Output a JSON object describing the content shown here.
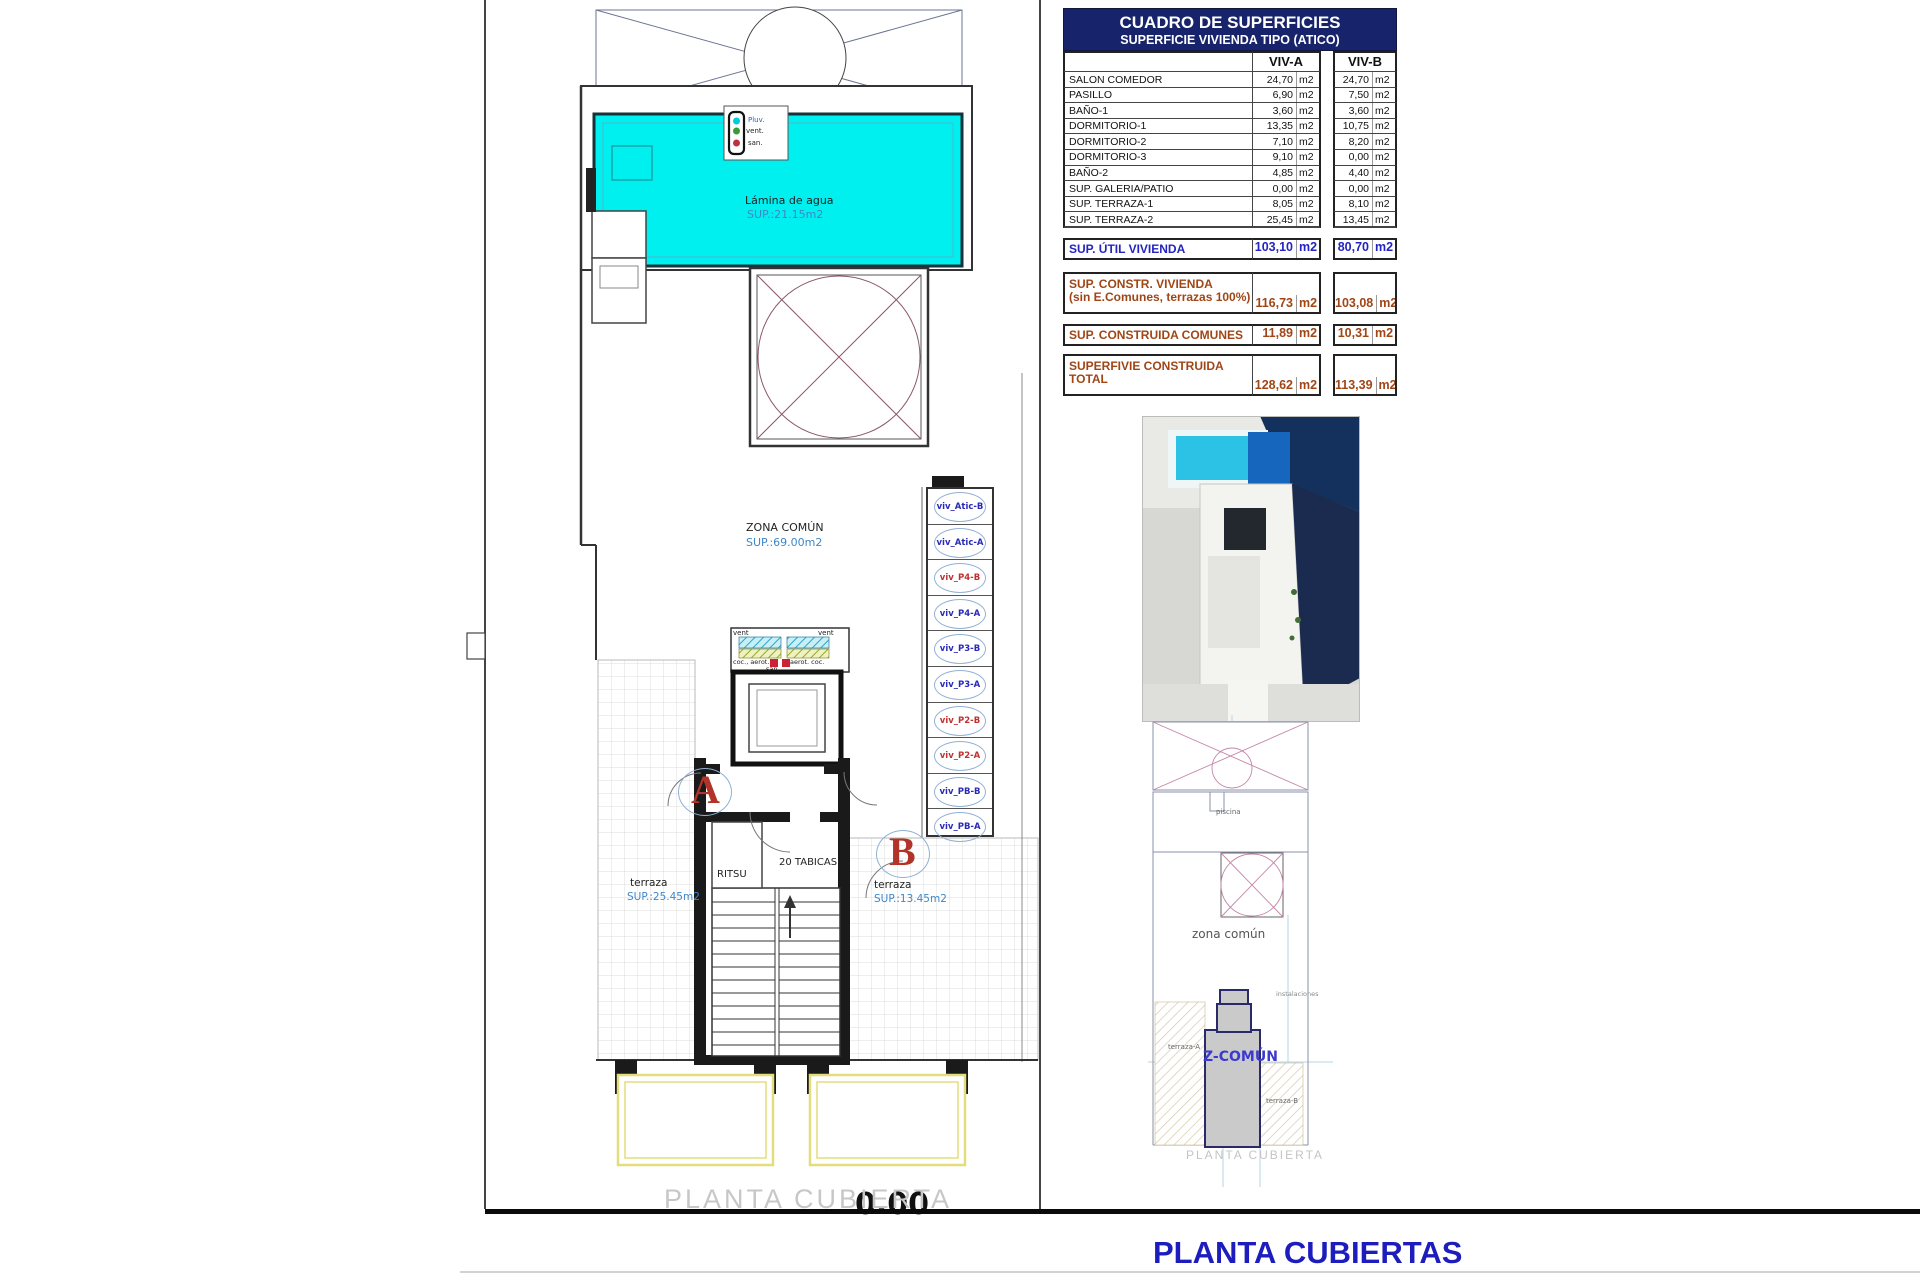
{
  "title": "PLANTA CUBIERTAS",
  "table": {
    "title": "CUADRO DE SUPERFICIES",
    "subtitle": "SUPERFICIE VIVIENDA TIPO  (ATICO)",
    "col_a": "VIV-A",
    "col_b": "VIV-B",
    "unit": "m2",
    "rows": [
      {
        "label": "SALON COMEDOR",
        "a": "24,70",
        "b": "24,70"
      },
      {
        "label": "PASILLO",
        "a": "6,90",
        "b": "7,50"
      },
      {
        "label": "BAÑO-1",
        "a": "3,60",
        "b": "3,60"
      },
      {
        "label": "DORMITORIO-1",
        "a": "13,35",
        "b": "10,75"
      },
      {
        "label": "DORMITORIO-2",
        "a": "7,10",
        "b": "8,20"
      },
      {
        "label": "DORMITORIO-3",
        "a": "9,10",
        "b": "0,00"
      },
      {
        "label": "BAÑO-2",
        "a": "4,85",
        "b": "4,40"
      },
      {
        "label": "SUP. GALERIA/PATIO",
        "a": "0,00",
        "b": "0,00"
      },
      {
        "label": "SUP. TERRAZA-1",
        "a": "8,05",
        "b": "8,10"
      },
      {
        "label": "SUP. TERRAZA-2",
        "a": "25,45",
        "b": "13,45"
      }
    ],
    "summary": [
      {
        "label": "SUP. ÚTIL VIVIENDA",
        "a": "103,10",
        "b": "80,70"
      },
      {
        "label": "SUP. CONSTR. VIVIENDA",
        "label2": "(sin E.Comunes, terrazas 100%)",
        "a": "116,73",
        "b": "103,08"
      },
      {
        "label": "SUP. CONSTRUIDA COMUNES",
        "a": "11,89",
        "b": "10,31"
      },
      {
        "label": "SUPERFIVIE CONSTRUIDA",
        "label2": "TOTAL",
        "a": "128,62",
        "b": "113,39"
      }
    ]
  },
  "plan": {
    "pool_label": "Lámina de agua",
    "pool_sup": "SUP.:21.15m2",
    "zona_comun": "ZONA COMÚN",
    "zona_comun_sup": "SUP.:69.00m2",
    "terraza_a": "terraza",
    "terraza_a_sup": "SUP.:25.45m2",
    "terraza_b": "terraza",
    "terraza_b_sup": "SUP.:13.45m2",
    "ritsu": "RITSU",
    "tabicas": "20 TABICAS",
    "letter_a": "A",
    "letter_b": "B",
    "level_mark": "0.00",
    "caption": "PLANTA CUBIERTA",
    "riser": {
      "pluv": "Pluv.",
      "vent": "vent.",
      "san": "san."
    },
    "core_legend": {
      "vent_l": "vent",
      "vent_r": "vent",
      "coc_l": "coc., aerot.",
      "coc_r": "aerot. coc.",
      "san": "san."
    },
    "shafts": [
      {
        "label": "viv_Atic-B",
        "tone": "blue"
      },
      {
        "label": "viv_Atic-A",
        "tone": "blue"
      },
      {
        "label": "viv_P4-B",
        "tone": "red"
      },
      {
        "label": "viv_P4-A",
        "tone": "blue"
      },
      {
        "label": "viv_P3-B",
        "tone": "blue"
      },
      {
        "label": "viv_P3-A",
        "tone": "blue"
      },
      {
        "label": "viv_P2-B",
        "tone": "red"
      },
      {
        "label": "viv_P2-A",
        "tone": "red"
      },
      {
        "label": "viv_PB-B",
        "tone": "blue"
      },
      {
        "label": "viv_PB-A",
        "tone": "blue"
      }
    ]
  },
  "mini_plan": {
    "piscina": "piscina",
    "zona_comun": "zona común",
    "instalaciones": "instalaciones",
    "z_comun": "Z-COMÚN",
    "terraza_a": "terraza-A",
    "terraza_b": "terraza-B",
    "caption": "PLANTA CUBIERTA"
  },
  "colors": {
    "accent_blue": "#2424c0",
    "brown": "#a04616",
    "pool_cyan": "#00efef",
    "navy_header": "#17246b",
    "title_blue": "#1d1dbe"
  }
}
